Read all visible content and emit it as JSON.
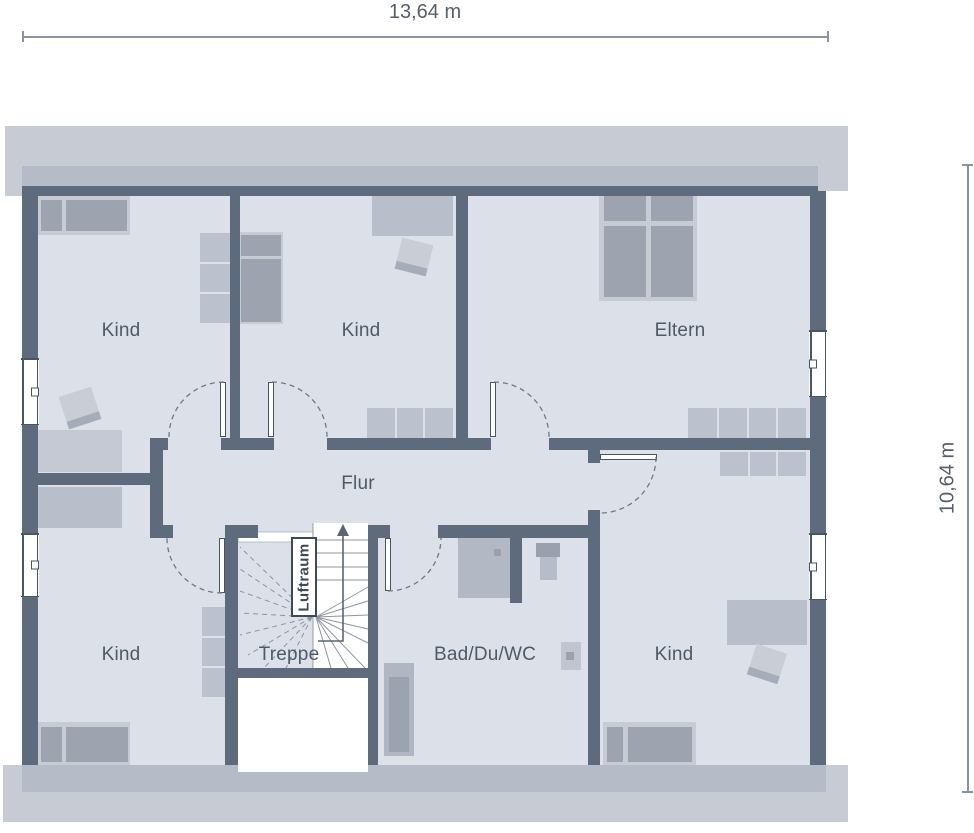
{
  "plan_title": "Dachgeschoss Grundriss",
  "dimensions": {
    "width_label": "13,64 m",
    "depth_label": "10,64 m"
  },
  "rooms": {
    "kind_top_left": {
      "label": "Kind"
    },
    "kind_top_middle": {
      "label": "Kind"
    },
    "eltern": {
      "label": "Eltern"
    },
    "flur": {
      "label": "Flur"
    },
    "treppe": {
      "label": "Treppe"
    },
    "luftraum": {
      "label": "Luftraum"
    },
    "kind_bottom_left": {
      "label": "Kind"
    },
    "bad": {
      "label": "Bad/Du/WC"
    },
    "kind_bottom_right": {
      "label": "Kind"
    }
  },
  "colors": {
    "wall": "#5e6b7d",
    "floor": "#dce0e8",
    "furniture_light": "#c7cbd4",
    "furniture_medium": "#bcc2cd",
    "furniture_dark": "#9da4b0",
    "roof_light": "#c6cbd4",
    "roof_dark": "#b6bcc7",
    "label_text": "#4f5a67",
    "dimension_text": "#565f6b",
    "door_arc": "#6e7a89"
  }
}
